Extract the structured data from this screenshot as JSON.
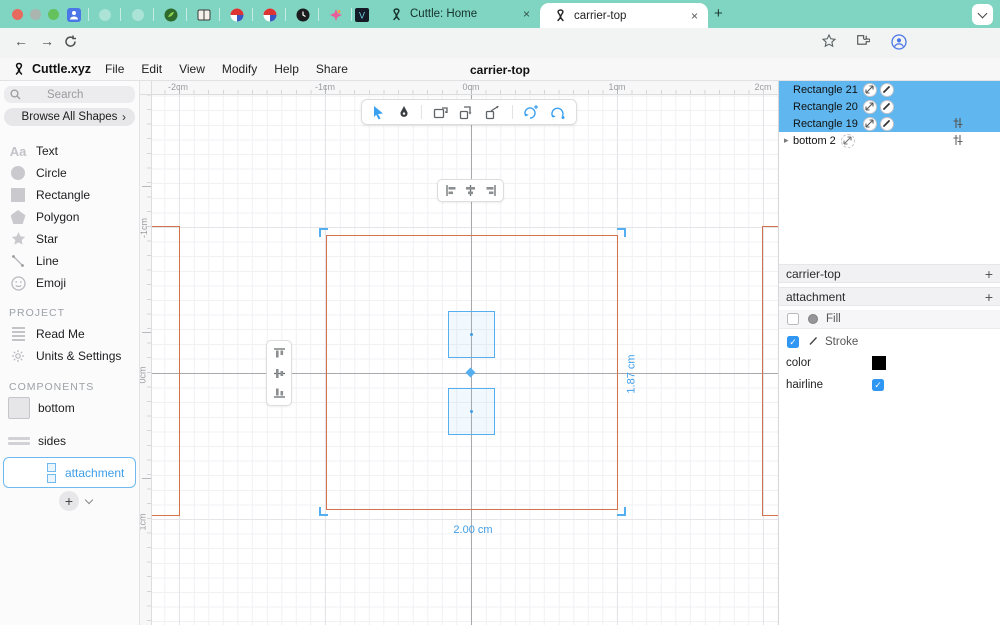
{
  "browser": {
    "tabs": [
      {
        "label": "Cuttle: Home",
        "active": false
      },
      {
        "label": "carrier-top",
        "active": true
      }
    ],
    "close_glyph": "×",
    "new_tab_glyph": "+",
    "url": "cuttle.xyz/@keremdiren/carrier-top-RnRlsrHLgOKJ",
    "finish_update_label": "Finish update",
    "finish_update_menu_glyph": "⋮",
    "pinned_tab_icons": [
      "profile",
      "ghost",
      "ghost",
      "plant",
      "book",
      "paw-red",
      "paw-blue",
      "clock",
      "spark",
      "v-logo"
    ]
  },
  "menubar": {
    "brand": "Cuttle.xyz",
    "items": [
      "File",
      "Edit",
      "View",
      "Modify",
      "Help",
      "Share"
    ],
    "document_title": "carrier-top"
  },
  "sidebar": {
    "search_placeholder": "Search",
    "browse_label": "Browse All Shapes",
    "browse_arrow": "›",
    "shapes": [
      {
        "label": "Text"
      },
      {
        "label": "Circle"
      },
      {
        "label": "Rectangle"
      },
      {
        "label": "Polygon"
      },
      {
        "label": "Star"
      },
      {
        "label": "Line"
      },
      {
        "label": "Emoji"
      }
    ],
    "project_header": "PROJECT",
    "project_items": [
      {
        "label": "Read Me"
      },
      {
        "label": "Units & Settings"
      }
    ],
    "components_header": "COMPONENTS",
    "components": [
      {
        "label": "bottom",
        "selected": false
      },
      {
        "label": "sides",
        "selected": false
      },
      {
        "label": "attachment",
        "selected": true
      }
    ],
    "add_component_glyph": "+"
  },
  "canvas": {
    "ruler_top_labels": [
      "-2cm",
      "-1cm",
      "0cm",
      "1cm",
      "2cm"
    ],
    "ruler_left_labels": [
      "-1cm",
      "0cm",
      "1cm"
    ],
    "selection_width_label": "2.00 cm",
    "selection_height_label": "1.87 cm"
  },
  "layers": {
    "rows": [
      {
        "name": "Rectangle 21",
        "selected": true
      },
      {
        "name": "Rectangle 20",
        "selected": true
      },
      {
        "name": "Rectangle 19",
        "selected": true
      },
      {
        "name": "bottom 2",
        "selected": false,
        "disclosure": "▸"
      }
    ]
  },
  "inspector": {
    "sections": [
      {
        "title": "carrier-top",
        "add_glyph": "+"
      },
      {
        "title": "attachment",
        "add_glyph": "+"
      }
    ],
    "fill_label": "Fill",
    "stroke_label": "Stroke",
    "color_label": "color",
    "hairline_label": "hairline",
    "stroke_color_value": "#000000",
    "fill_checked": false,
    "stroke_checked": true,
    "hairline_checked": true,
    "check_glyph": "✓"
  },
  "colors": {
    "chrome_teal": "#7fd4c2",
    "selection_blue": "#55aef0",
    "layer_selected_blue": "#60b7f0",
    "shape_stroke_orange": "#d2734e",
    "checkbox_blue": "#2f96f3",
    "stroke_swatch": "#000000"
  }
}
